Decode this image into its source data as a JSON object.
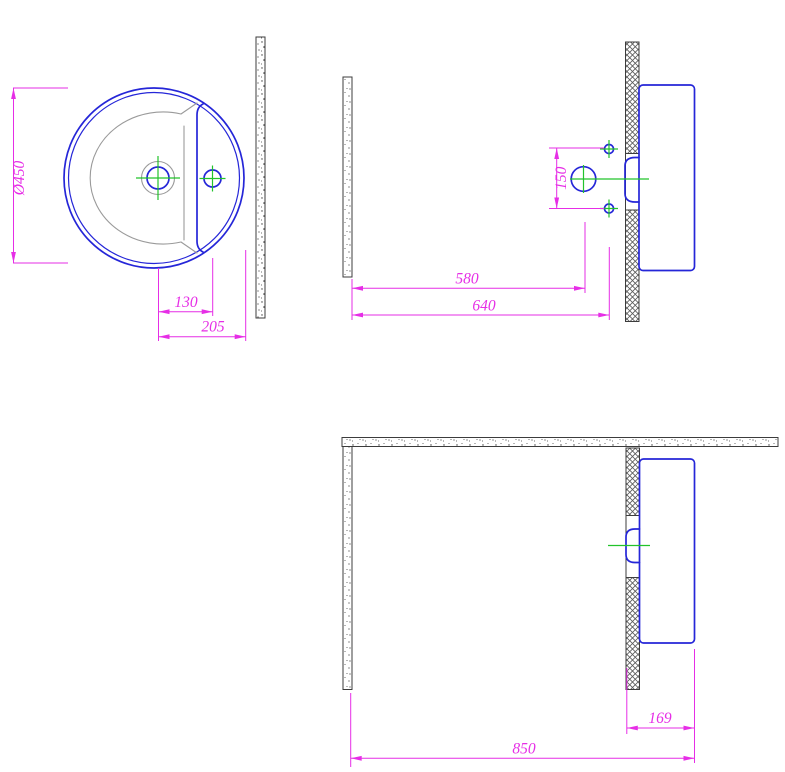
{
  "drawing": {
    "subject": "Wall-mounted round washbasin installation drawing, three orthographic views",
    "colors": {
      "fixture": "#2526d8",
      "dimension": "#e62ee6",
      "centerline": "#22c32b",
      "bowl-edge": "#9a9a9a",
      "wall-outline": "#3c3c3c",
      "hatch": "#5a5a5a",
      "background": "#ffffff"
    },
    "views": {
      "top": {
        "name": "Top view",
        "dims": {
          "diameter": "Ø450",
          "drain_to_tap": "130",
          "drain_to_rim": "205"
        }
      },
      "front": {
        "name": "Front view",
        "dims": {
          "hole_spacing": "150",
          "wall_to_drain": "580",
          "wall_to_holes": "640"
        }
      },
      "side": {
        "name": "Side view",
        "dims": {
          "overhang_depth": "169",
          "overall_span": "850"
        }
      }
    }
  }
}
